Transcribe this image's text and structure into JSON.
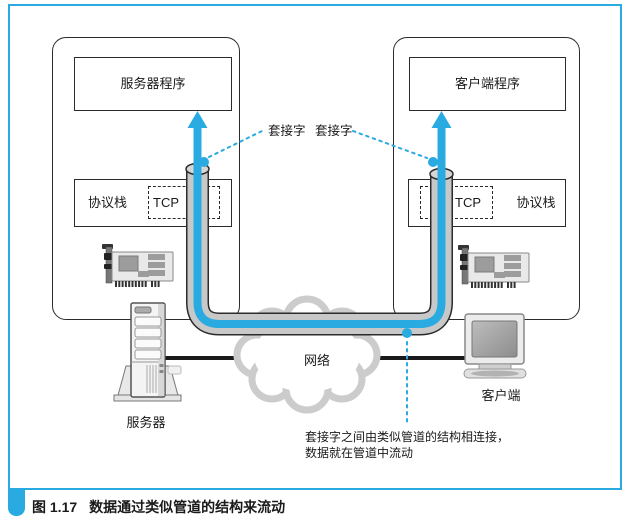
{
  "figure": {
    "caption_label": "图 1.17",
    "caption_title": "数据通过类似管道的结构来流动"
  },
  "server_host": {
    "program_label": "服务器程序",
    "stack_label": "协议栈",
    "tcp_label": "TCP",
    "machine_label": "服务器"
  },
  "client_host": {
    "program_label": "客户端程序",
    "stack_label": "协议栈",
    "tcp_label": "TCP",
    "machine_label": "客户端"
  },
  "connection": {
    "socket_label_left": "套接字",
    "socket_label_right": "套接字",
    "network_label": "网络",
    "note_line1": "套接字之间由类似管道的结构相连接，",
    "note_line2": "数据就在管道中流动"
  },
  "colors": {
    "accent_blue": "#29ABE2",
    "pipe_gray": "#c8c8c8",
    "cloud_gray": "#cccccc",
    "outline_dark": "#2b2b2b",
    "cable_black": "#1a1a1a"
  }
}
